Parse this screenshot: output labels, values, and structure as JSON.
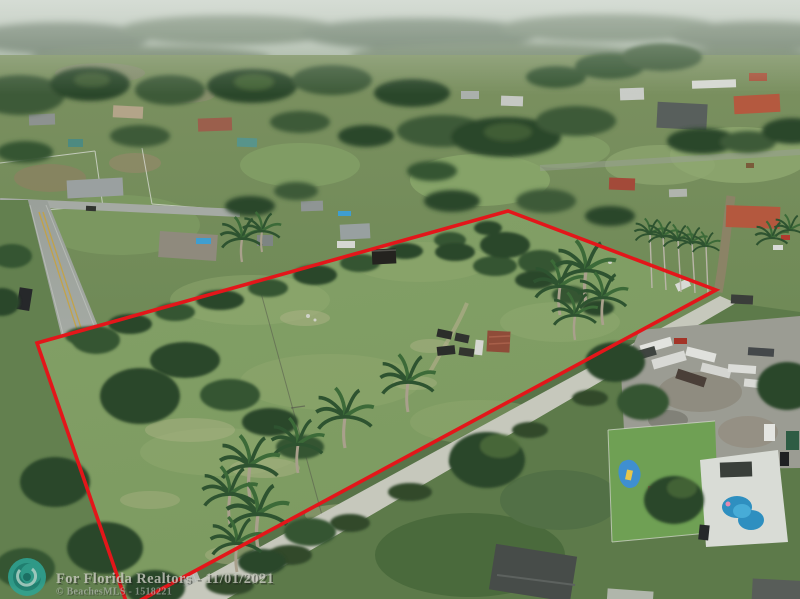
{
  "image": {
    "type": "aerial-drone-real-estate-photo",
    "description": "Aerial drone view of a vacant grassy acreage parcel outlined in red, surrounded by a suburban ranch neighborhood, a bordering road on the left, a truck/boat storage yard and backyard pool on the right, hazy tree line horizon at top"
  },
  "watermark": {
    "line1": "For Florida Realtors - 11/01/2021",
    "line2": "© BeachesMLS - 1518221",
    "logo": "beachesmls-wave-logo"
  },
  "boundary": {
    "points": "37,343 508,211 716,290 128,607",
    "color": "#e3161a",
    "stroke_width": "3.6"
  },
  "palette": {
    "field_green": "#7f9c64",
    "lawn_dark_green": "#4e7040",
    "tree_dark": "#2b4629",
    "road_gray": "#a5aaa3",
    "access_road_gray": "#c6c8bc",
    "pool_blue": "#2e8fc0",
    "sky_haze": "#c3ccc4",
    "terracotta_roof": "#b4593f",
    "logo_teal": "#2fa393",
    "watermark_text": "#c8c9c0",
    "boundary_red": "#e3161a"
  }
}
